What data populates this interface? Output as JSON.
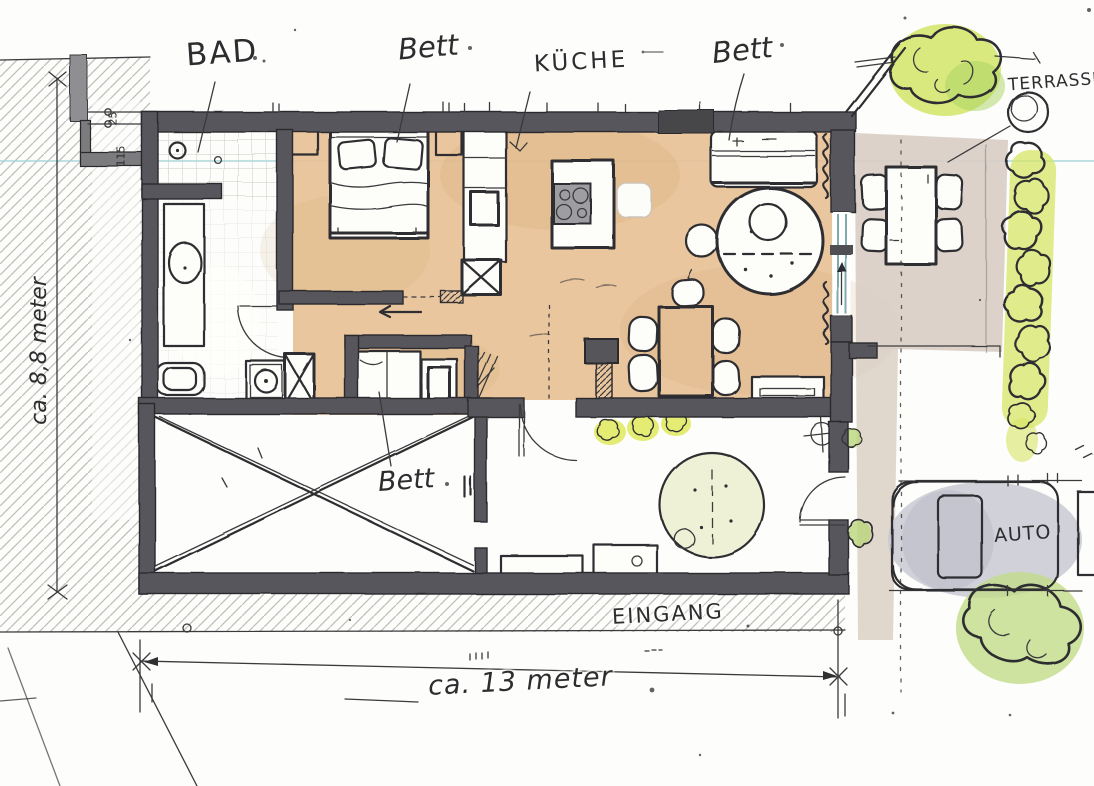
{
  "drawing": {
    "kind_note": "hand-drawn apartment floor plan sketch (scanned)",
    "annotations": {
      "bathroom": "BAD",
      "bedroom_top": "Bett",
      "kitchen": "KÜCHE",
      "sofa_bed": "Bett",
      "terrace": "TERRASSE",
      "bedroom_middle": "Bett",
      "entrance": "EINGANG",
      "car": "AUTO"
    },
    "dimensions": {
      "width": "ca. 13 meter",
      "depth": "ca. 8,8 meter",
      "offset_top": "25",
      "offset_left": "115"
    },
    "colors": {
      "ink": "#2f2f31",
      "wall": "#56565b",
      "floor_wash": "#e8c094",
      "patio_wash": "#d9cec6",
      "foliage_wash": "#cfe35f",
      "hedge_wash": "#d6e565",
      "tree_fill": "#eff1d6",
      "car_pad": "#c9c9d2",
      "scan_line": "#9fd2d8"
    }
  }
}
